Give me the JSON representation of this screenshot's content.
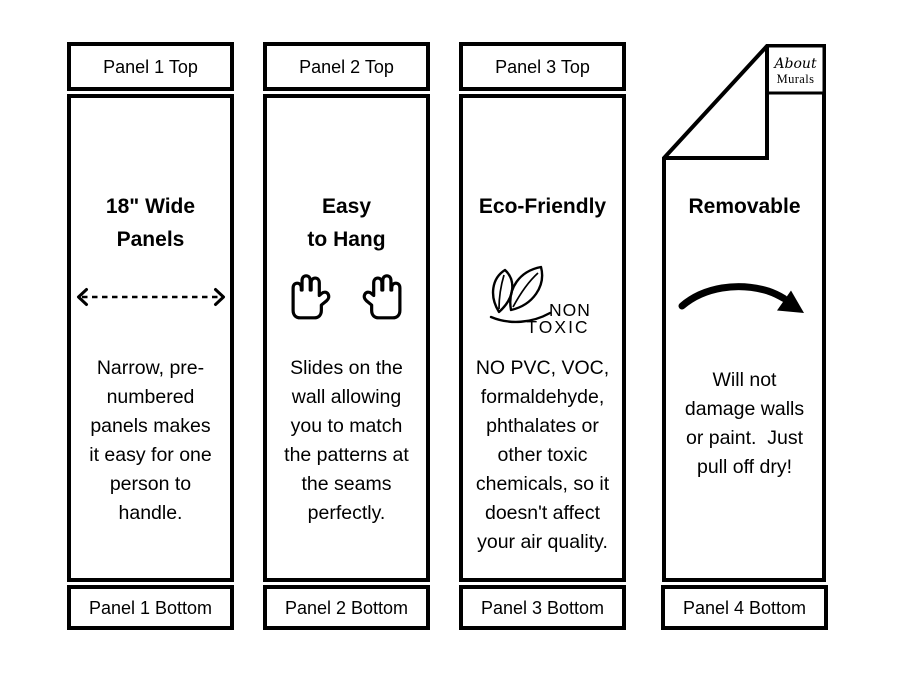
{
  "colors": {
    "ink": "#000000",
    "paper": "#ffffff"
  },
  "panels": [
    {
      "top_label": "Panel 1 Top",
      "title": "18\" Wide\nPanels",
      "icon": "width-double-arrow-icon",
      "text": "Narrow, pre-\nnumbered\npanels makes\nit easy for one\nperson to\nhandle.",
      "bottom_label": "Panel 1 Bottom"
    },
    {
      "top_label": "Panel 2 Top",
      "title": "Easy\nto Hang",
      "icon": "raised-hands-icon",
      "text": "Slides on the\nwall allowing\nyou to match\nthe patterns at\nthe seams\nperfectly.",
      "bottom_label": "Panel 2 Bottom"
    },
    {
      "top_label": "Panel 3 Top",
      "title": "Eco-Friendly",
      "icon": "non-toxic-leaves-icon",
      "icon_text": {
        "line1": "NON",
        "line2": "TOXIC"
      },
      "text": "NO PVC, VOC,\nformaldehyde,\nphthalates or\nother toxic\nchemicals, so it\ndoesn't affect\nyour air quality.",
      "bottom_label": "Panel 3 Bottom"
    },
    {
      "logo": {
        "line1": "About",
        "line2": "Murals"
      },
      "title": "Removable",
      "icon": "curved-arrow-icon",
      "text": "Will not\ndamage walls\nor paint.  Just\npull off dry!",
      "bottom_label": "Panel 4 Bottom"
    }
  ]
}
